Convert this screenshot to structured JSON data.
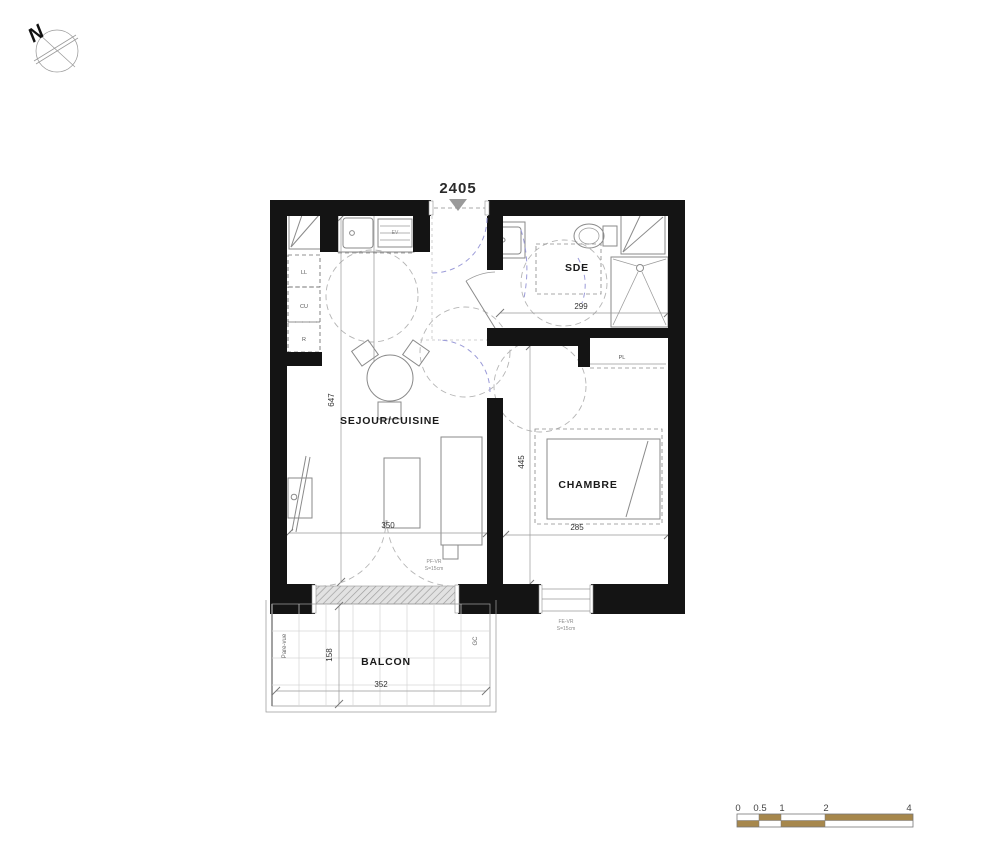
{
  "meta": {
    "title_number": "2405"
  },
  "north": {
    "label": "N"
  },
  "rooms": {
    "sejour": {
      "label": "SEJOUR/CUISINE",
      "dim_height": "647",
      "dim_width": "350"
    },
    "chambre": {
      "label": "CHAMBRE",
      "dim_height": "445",
      "dim_width": "285"
    },
    "sde": {
      "label": "SDE",
      "dim_width": "299"
    },
    "balcon": {
      "label": "BALCON",
      "dim_width": "352",
      "dim_depth": "158",
      "pare_vue": "Pare-vue",
      "gc": "GC"
    }
  },
  "kitchen": {
    "appliances": [
      {
        "label": "LL"
      },
      {
        "label": "CU"
      },
      {
        "label": "R"
      }
    ],
    "sink_label": "EV"
  },
  "closet": {
    "label": "PL"
  },
  "openings": {
    "balcony_door": {
      "line1": "PF-VR",
      "line2": "S=15cm"
    },
    "bedroom_window": {
      "line1": "FE-VR",
      "line2": "S=15cm"
    }
  },
  "scale_bar": {
    "labels": [
      "0",
      "0.5",
      "1",
      "2",
      "4"
    ]
  },
  "colors": {
    "wall": "#141414",
    "line": "#8a8a8a",
    "door_arc": "#9b9bd8",
    "scale_tan": "#a6874c",
    "entrance_triangle": "#9a9a9a"
  }
}
